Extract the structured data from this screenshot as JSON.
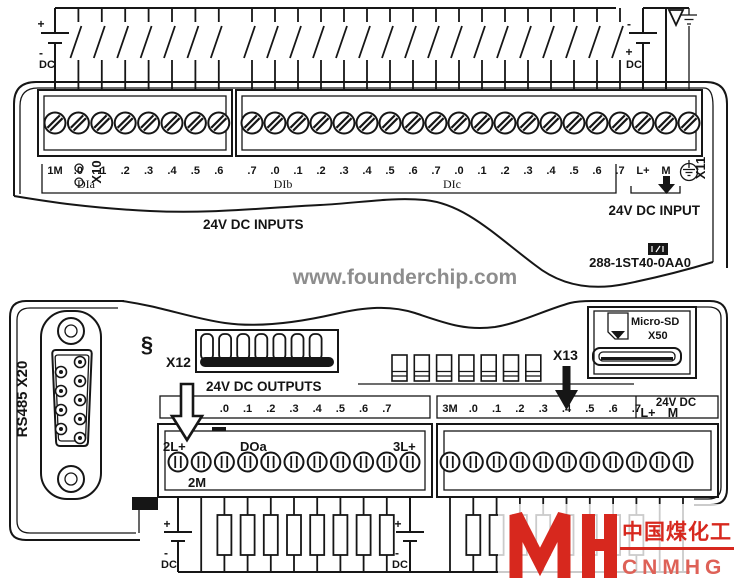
{
  "colors": {
    "ink": "#161616",
    "watermark_gray": "#8d8d8d",
    "logo_red": "#d7281e",
    "logo_red_light": "#de6157"
  },
  "top": {
    "x10": "X10",
    "x11": "X11",
    "dc_left": {
      "plus": "+",
      "minus": "-",
      "dc": "DC"
    },
    "dc_right": {
      "plus": "-",
      "minus": "+",
      "dc": "DC"
    },
    "block1_labels": [
      "1M",
      ".0",
      ".1",
      ".2",
      ".3",
      ".4",
      ".5",
      ".6"
    ],
    "block2_labels": [
      ".7",
      ".0",
      ".1",
      ".2",
      ".3",
      ".4",
      ".5",
      ".6",
      ".7",
      ".0",
      ".1",
      ".2",
      ".3",
      ".4",
      ".5",
      ".6",
      ".7"
    ],
    "lplus": "L+",
    "m": "M",
    "groups": [
      "DIa",
      "DIb",
      "DIc"
    ],
    "caption": "24V DC INPUTS",
    "power_caption": "24V DC INPUT",
    "part_number": "288-1ST40-0AA0"
  },
  "bottom": {
    "port": "RS485 X20",
    "x12": "X12",
    "x13": "X13",
    "clip": "§",
    "sd_line1": "Micro-SD",
    "sd_line2": "X50",
    "caption": "24V DC OUTPUTS",
    "bandA": [
      ".0",
      ".1",
      ".2",
      ".3",
      ".4",
      ".5",
      ".6",
      ".7"
    ],
    "bandB": [
      "3M",
      ".0",
      ".1",
      ".2",
      ".3",
      ".4",
      ".5",
      ".6",
      ".7"
    ],
    "sensor": {
      "title": "24V DC",
      "lplus": "L+",
      "m": "M"
    },
    "stripA": {
      "top_left": "2L+",
      "group": "DOa",
      "top_right": "3L+",
      "bottom_left": "2M"
    },
    "dc_left": {
      "plus": "+",
      "minus": "-",
      "dc": "DC"
    },
    "dc_right": {
      "plus": "+",
      "minus": "-",
      "dc": "DC"
    }
  },
  "watermarks": {
    "site": "www.founderchip.com",
    "cn": "中国煤化工",
    "en": "CNMHG"
  }
}
